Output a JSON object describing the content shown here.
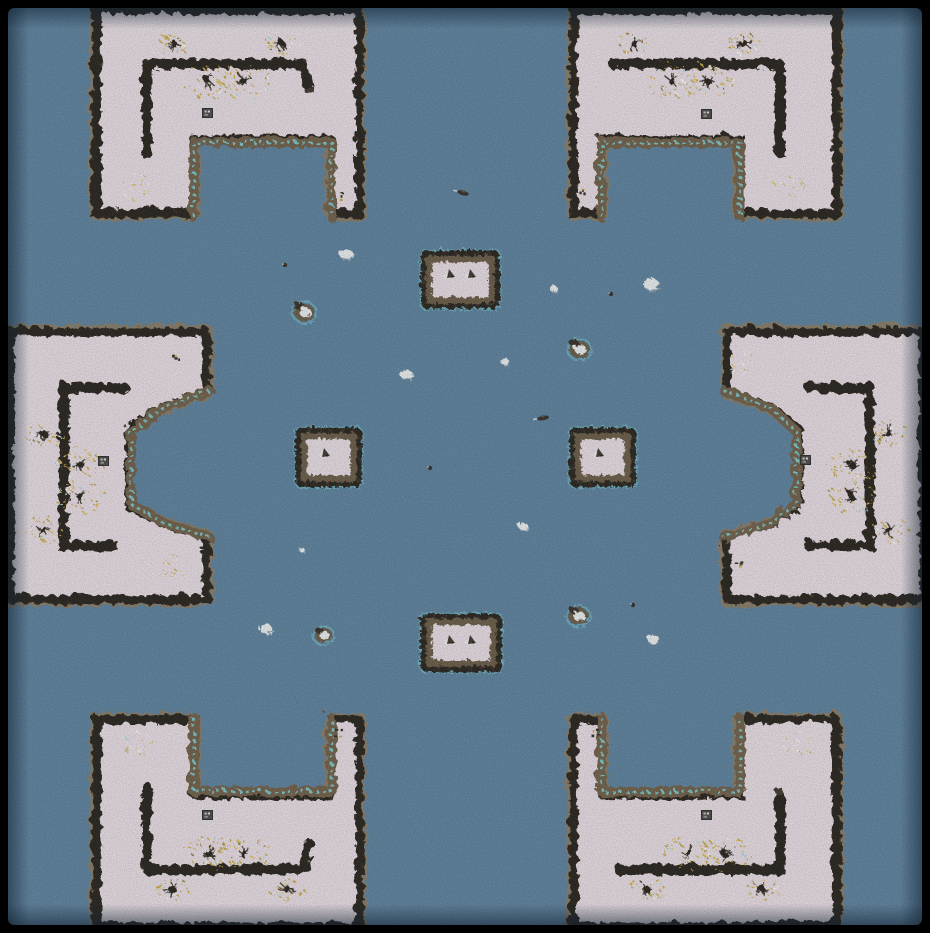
{
  "map": {
    "width": 930,
    "height": 933,
    "theater": "snow",
    "palette": {
      "water": "#5d83a0",
      "snow": "#eae0e7",
      "cliff_dark": "#3f382e",
      "cliff_knob": "#26211a",
      "fringe_tan": "#8d7d63",
      "beach_dirt": "#6f6049",
      "shallow_cyan": "#7cd6de",
      "ore_gold": "#c9a93f",
      "ore_gold2": "#e0c25e",
      "ore_dark": "#8a7a3a",
      "ore_white": "#ffffff",
      "ore_cyan": "#a8dde2",
      "tree_dark": "#27231c",
      "tree_spoke": "#464033",
      "building_gray": "#4a4a4a",
      "building_edge": "#2c2c2c",
      "floe_white": "#eef2f2",
      "floe_shadow": "#b9c6ca",
      "rock_brown": "#6b5c47",
      "rock_dark": "#352f27",
      "unit_dark": "#3c382f",
      "unit_white": "#f2f2ee",
      "ship_dark": "#33302a",
      "frame": "#000000",
      "vignette": "#102030"
    },
    "landmasses": [
      {
        "id": "top-left",
        "path": "M95,8 L358,8 L358,212 L330,212 L330,138 L192,138 L192,212 L95,212 Z",
        "beach": "M192,215 L192,141 L330,141 L330,215",
        "bracket": "M145,152 L145,62 L302,62 L307,90",
        "trees": [
          [
            172,
            42,
            14
          ],
          [
            280,
            42,
            14
          ],
          [
            207,
            79,
            22
          ],
          [
            242,
            79,
            22
          ]
        ],
        "sparse": [
          [
            135,
            185
          ]
        ],
        "building": [
          207,
          113
        ]
      },
      {
        "id": "top-right",
        "path": "M572,8 L835,8 L835,212 L738,212 L738,138 L600,138 L600,212 L572,212 Z",
        "beach": "M600,215 L600,141 L738,141 L738,215",
        "bracket": "M612,62 L778,62 L778,150",
        "trees": [
          [
            633,
            42,
            14
          ],
          [
            742,
            42,
            14
          ],
          [
            670,
            79,
            22
          ],
          [
            706,
            79,
            22
          ]
        ],
        "sparse": [
          [
            787,
            185
          ]
        ],
        "building": [
          706,
          114
        ]
      },
      {
        "id": "bottom-left",
        "path": "M95,718 L192,718 L192,793 L330,793 L330,718 L358,718 L358,925 L95,925 Z",
        "beach": "M192,716 L192,790 L330,790 L330,716",
        "bracket": "M145,786 L145,868 L302,868 L307,842",
        "trees": [
          [
            207,
            852,
            22
          ],
          [
            242,
            852,
            22
          ],
          [
            170,
            887,
            14
          ],
          [
            285,
            887,
            14
          ]
        ],
        "sparse": [
          [
            135,
            742
          ]
        ],
        "building": [
          207,
          815
        ]
      },
      {
        "id": "bottom-right",
        "path": "M572,718 L600,718 L600,793 L738,793 L738,718 L835,718 L835,925 L572,925 Z",
        "beach": "M600,716 L600,790 L738,790 L738,716",
        "bracket": "M618,868 L778,868 L778,788",
        "trees": [
          [
            688,
            852,
            22
          ],
          [
            723,
            852,
            22
          ],
          [
            645,
            887,
            14
          ],
          [
            760,
            887,
            14
          ]
        ],
        "sparse": [
          [
            795,
            742
          ]
        ],
        "building": [
          706,
          815
        ]
      },
      {
        "id": "left-middle",
        "path": "M8,330 L205,330 L205,390 L160,406 L128,428 L128,505 L160,521 L205,535 L205,598 L8,598 Z",
        "beach": "M208,389 L160,407 L130,430 L130,503 L160,520 L208,536",
        "bracket": "M122,386 L62,386 L62,544 L117,544",
        "trees": [
          [
            42,
            432,
            16
          ],
          [
            42,
            528,
            16
          ],
          [
            78,
            463,
            20
          ],
          [
            78,
            495,
            20
          ]
        ],
        "sparse": [
          [
            170,
            565
          ]
        ],
        "building": [
          103,
          461
        ]
      },
      {
        "id": "right-middle",
        "path": "M922,330 L725,330 L725,390 L770,406 L797,428 L797,505 L770,521 L725,535 L725,598 L922,598 Z",
        "beach": "M722,389 L770,407 L795,430 L795,503 L770,520 L722,536",
        "bracket": "M808,386 L868,386 L868,544 L808,544",
        "trees": [
          [
            887,
            432,
            16
          ],
          [
            887,
            528,
            16
          ],
          [
            850,
            463,
            20
          ],
          [
            850,
            495,
            20
          ]
        ],
        "sparse": [
          [
            740,
            363
          ]
        ],
        "building": [
          805,
          460
        ]
      }
    ],
    "islands": [
      {
        "id": "north",
        "x": 422,
        "y": 252,
        "w": 74,
        "h": 53,
        "units": [
          [
            450,
            274
          ],
          [
            471,
            274
          ]
        ]
      },
      {
        "id": "south",
        "x": 422,
        "y": 615,
        "w": 76,
        "h": 53,
        "units": [
          [
            450,
            640
          ],
          [
            471,
            640
          ]
        ]
      },
      {
        "id": "west",
        "x": 297,
        "y": 429,
        "w": 61,
        "h": 54,
        "units": [
          [
            325,
            453
          ]
        ]
      },
      {
        "id": "east",
        "x": 571,
        "y": 429,
        "w": 61,
        "h": 54,
        "units": [
          [
            599,
            453
          ]
        ]
      }
    ],
    "ice_floes": [
      [
        345,
        253,
        14
      ],
      [
        552,
        287,
        8
      ],
      [
        650,
        283,
        16
      ],
      [
        405,
        373,
        13
      ],
      [
        503,
        360,
        9
      ],
      [
        522,
        525,
        10
      ],
      [
        300,
        548,
        6
      ],
      [
        265,
        628,
        13
      ],
      [
        652,
        638,
        12
      ]
    ],
    "islets": [
      [
        303,
        311,
        20
      ],
      [
        578,
        348,
        20
      ],
      [
        322,
        634,
        17
      ],
      [
        577,
        615,
        20
      ]
    ],
    "ships": [
      [
        463,
        193,
        15
      ],
      [
        543,
        418,
        -10
      ]
    ],
    "buoys": [
      [
        285,
        265
      ],
      [
        611,
        294
      ],
      [
        430,
        468
      ],
      [
        633,
        605
      ]
    ],
    "debris": [
      [
        341,
        195
      ],
      [
        580,
        192
      ],
      [
        175,
        355
      ],
      [
        738,
        563
      ],
      [
        337,
        732
      ],
      [
        593,
        732
      ]
    ]
  }
}
